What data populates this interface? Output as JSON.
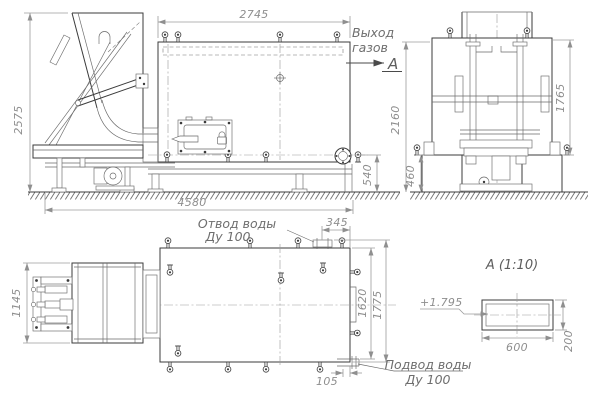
{
  "colors": {
    "background": "#ffffff",
    "object_line": "#3b3b3b",
    "dimension_line": "#9b9b9b",
    "dimension_text": "#8e8e8e",
    "label_text": "#6e6e6e"
  },
  "views": {
    "side": {
      "dim_body_width": "2745",
      "dim_total_height": "2575",
      "dim_overall_length": "4580",
      "dim_flange_height": "540",
      "gas_label_1": "Выход",
      "gas_label_2": "газов",
      "view_mark": "А"
    },
    "front": {
      "dim_overall_height": "2160",
      "dim_casing_height": "1765",
      "dim_foundation_height": "460"
    },
    "plan": {
      "dim_feeder_width": "1145",
      "dim_outlet_offset": "345",
      "dim_width_inner": "1620",
      "dim_width_outer": "1775",
      "dim_inlet_offset": "105",
      "outlet_label_1": "Отвод воды",
      "outlet_label_2": "Ду 100",
      "inlet_label_1": "Подвод воды",
      "inlet_label_2": "Ду 100"
    },
    "detail": {
      "title": "А  (1:10)",
      "dim_width": "600",
      "dim_height": "200",
      "elevation": "+1.795"
    }
  }
}
